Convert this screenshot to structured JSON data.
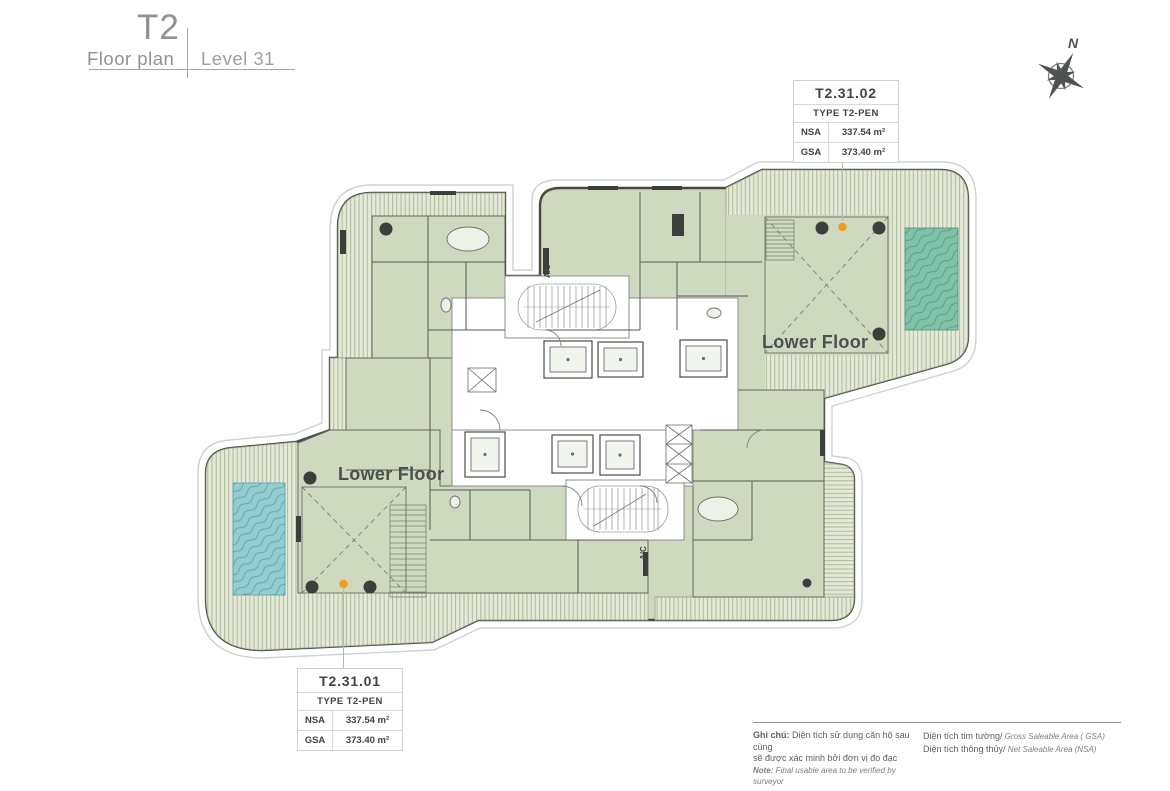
{
  "header": {
    "project": "T2",
    "subtitle": "Floor plan",
    "level": "Level 31"
  },
  "compass": {
    "north_label": "N"
  },
  "units": [
    {
      "id": "T2.31.01",
      "type_label": "TYPE T2-PEN",
      "nsa_label": "NSA",
      "nsa_value": "337.54 m²",
      "gsa_label": "GSA",
      "gsa_value": "373.40 m²"
    },
    {
      "id": "T2.31.02",
      "type_label": "TYPE T2-PEN",
      "nsa_label": "NSA",
      "nsa_value": "337.54 m²",
      "gsa_label": "GSA",
      "gsa_value": "373.40 m²"
    }
  ],
  "plan": {
    "lower_floor_label": "Lower Floor",
    "ac_label": "A/C"
  },
  "legend": {
    "note_title": "Ghi chú:",
    "note_vi_line1": "Diện tích sử dụng căn hộ sau cùng",
    "note_vi_line2": "sẽ được xác minh bởi đơn vị đo đạc",
    "note_en_title": "Note:",
    "note_en_rest": " Final usable area to be verified by surveyor",
    "gsa_vi": "Diện tích tim tường/",
    "gsa_en": " Gross Saleable Area ( GSA)",
    "nsa_vi": "Diện tích thông thủy/",
    "nsa_en": " Net Saleable Area (NSA)"
  },
  "colors": {
    "room_green": "#cfd9c0",
    "terrace_bg": "#e4e8d6",
    "terrace_line": "#a9b69a",
    "pool_teal": "#7ec2a9",
    "pool_cyan": "#92cdd2",
    "wall_dark": "#454a45",
    "accent_orange": "#f39a1e",
    "title_gray": "#8d9393",
    "text_dark": "#3e4542"
  }
}
